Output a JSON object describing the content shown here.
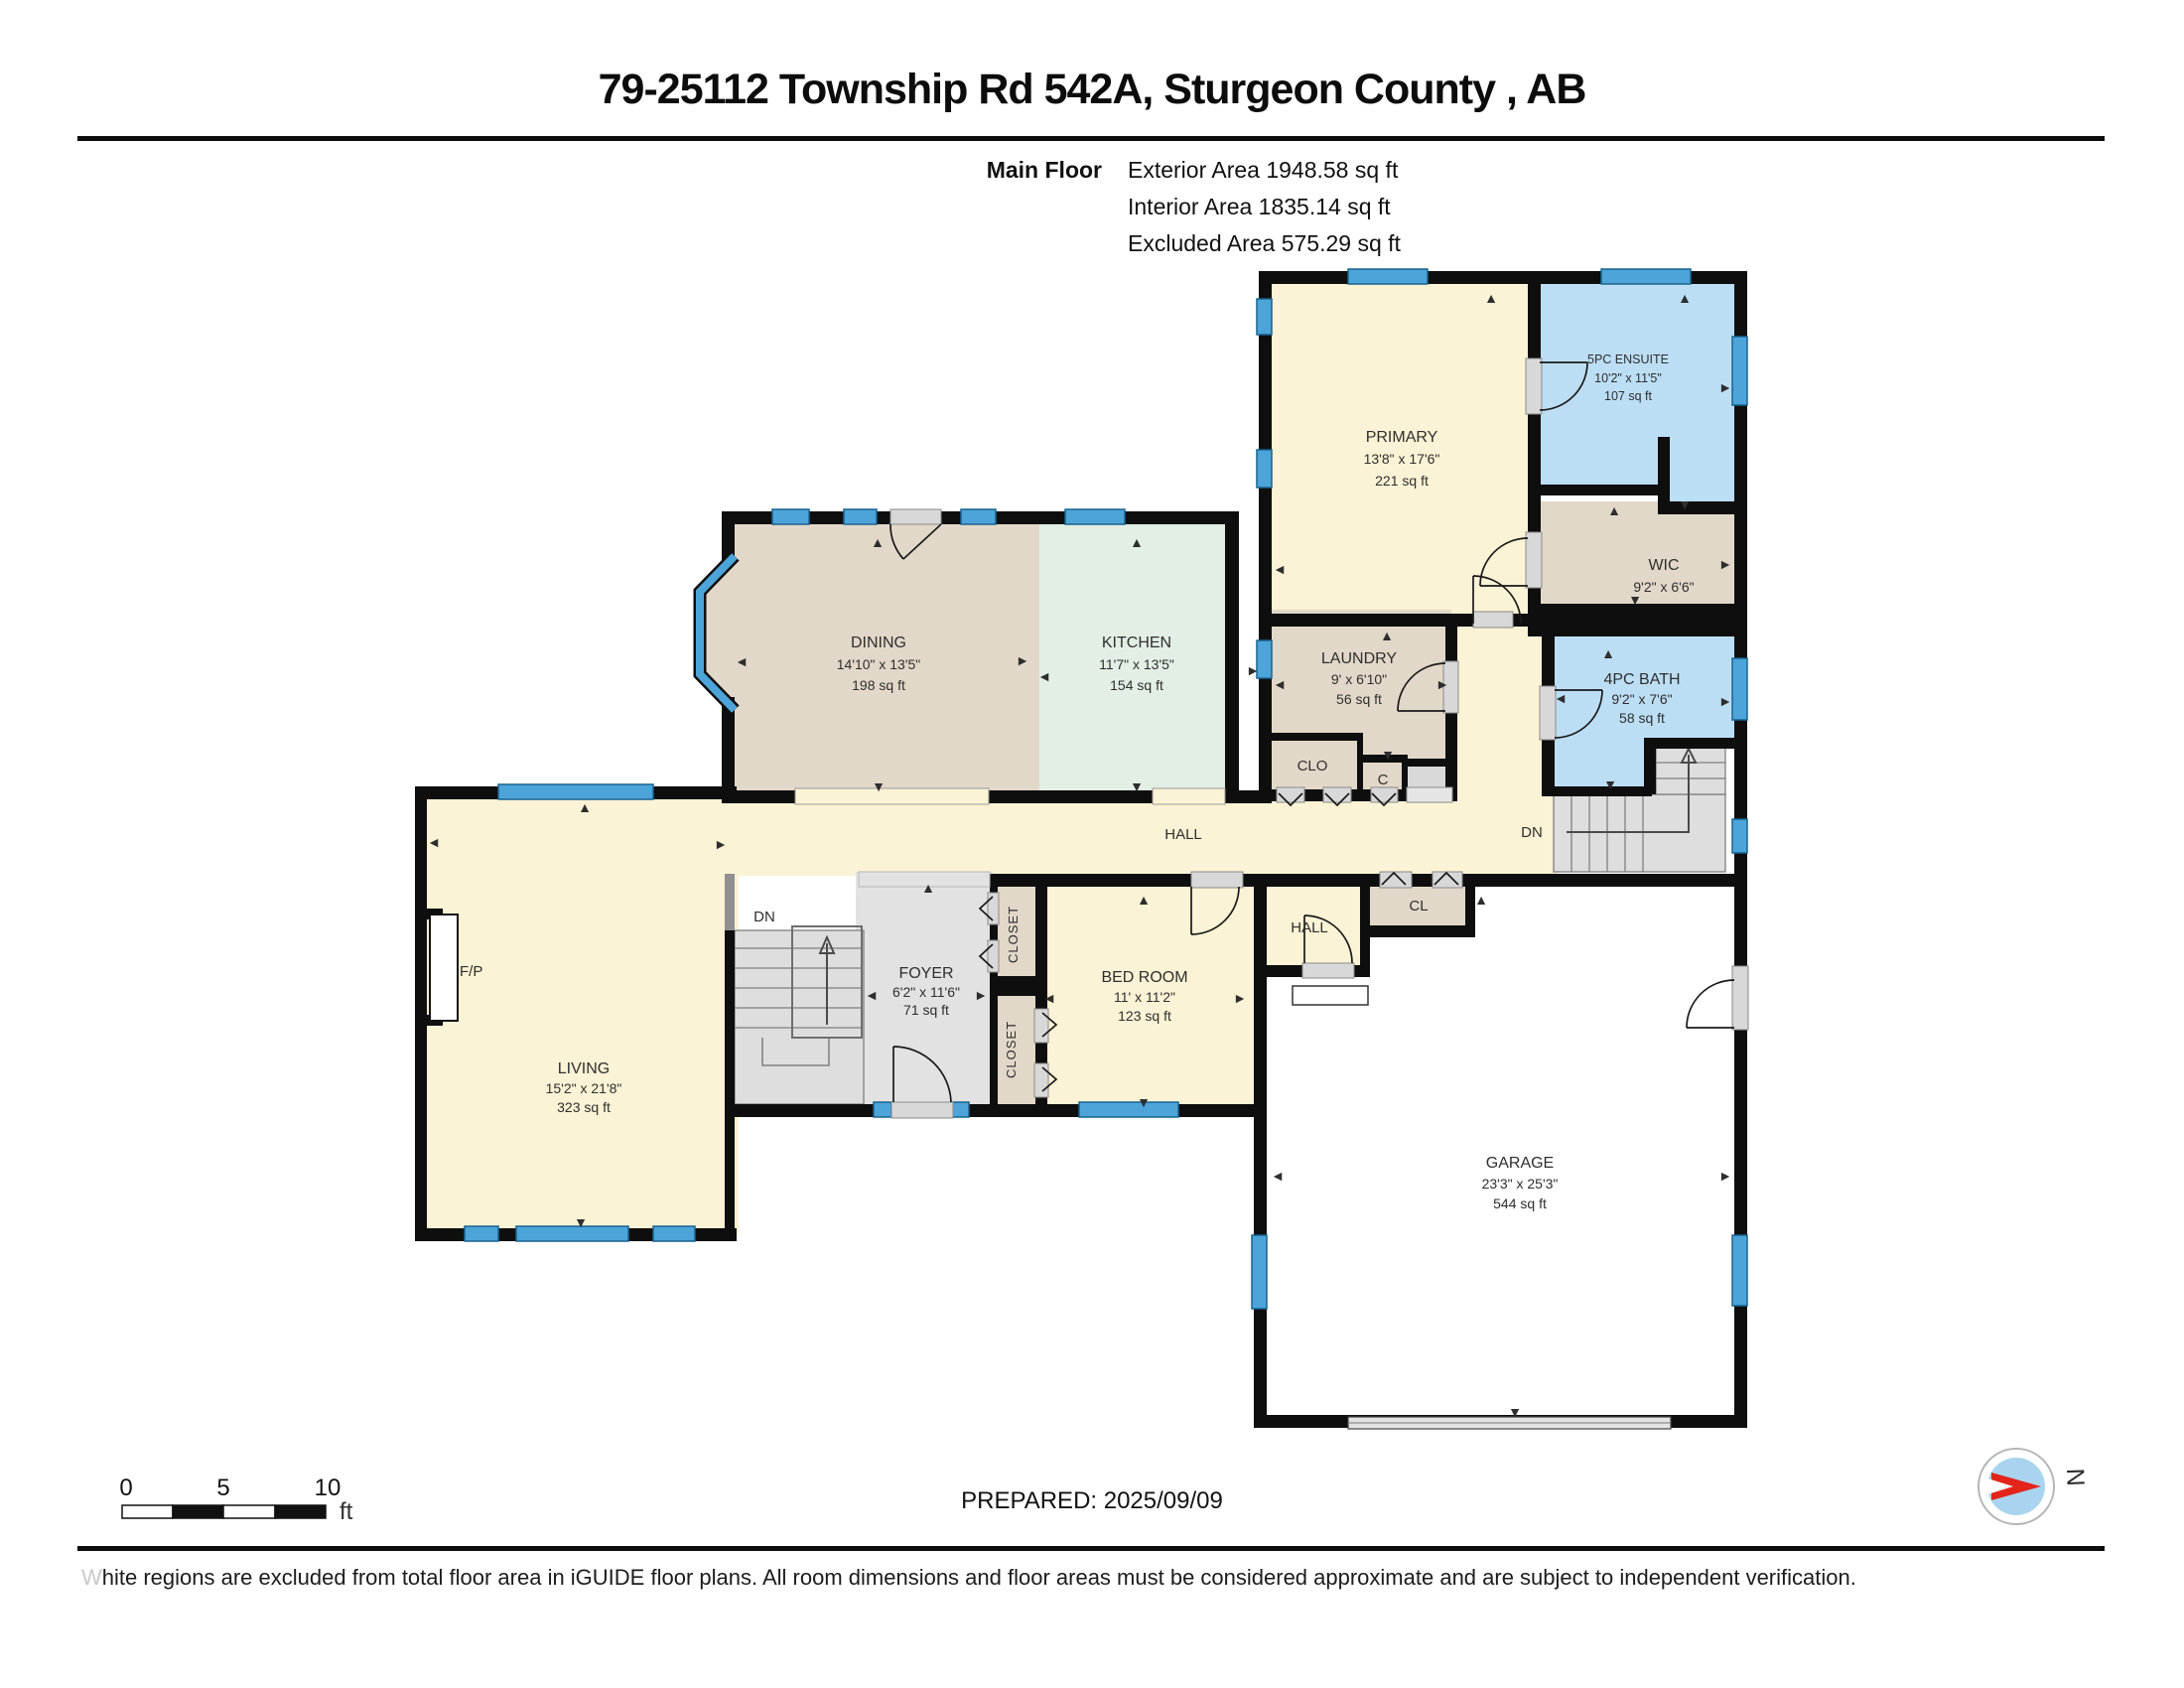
{
  "page": {
    "title": "79-25112 Township Rd 542A, Sturgeon County , AB"
  },
  "summary": {
    "floor_label": "Main Floor",
    "lines": [
      "Exterior Area 1948.58 sq ft",
      "Interior Area 1835.14 sq ft",
      "Excluded Area 575.29 sq ft"
    ]
  },
  "rooms": {
    "primary": {
      "name": "PRIMARY",
      "dims": "13'8\" x 17'6\"",
      "area": "221 sq ft"
    },
    "ensuite": {
      "name": "5PC ENSUITE",
      "dims": "10'2\" x 11'5\"",
      "area": "107 sq ft"
    },
    "wic": {
      "name": "WIC",
      "dims": "9'2\" x 6'6\""
    },
    "dining": {
      "name": "DINING",
      "dims": "14'10\" x 13'5\"",
      "area": "198 sq ft"
    },
    "kitchen": {
      "name": "KITCHEN",
      "dims": "11'7\" x 13'5\"",
      "area": "154 sq ft"
    },
    "laundry": {
      "name": "LAUNDRY",
      "dims": "9' x 6'10\"",
      "area": "56 sq ft"
    },
    "bath": {
      "name": "4PC BATH",
      "dims": "9'2\" x 7'6\"",
      "area": "58 sq ft"
    },
    "living": {
      "name": "LIVING",
      "dims": "15'2\" x 21'8\"",
      "area": "323 sq ft"
    },
    "foyer": {
      "name": "FOYER",
      "dims": "6'2\" x 11'6\"",
      "area": "71 sq ft"
    },
    "bedroom": {
      "name": "BED ROOM",
      "dims": "11' x 11'2\"",
      "area": "123 sq ft"
    },
    "garage": {
      "name": "GARAGE",
      "dims": "23'3\" x 25'3\"",
      "area": "544 sq ft"
    }
  },
  "labels": {
    "hall_main": "HALL",
    "hall_small": "HALL",
    "cl": "CL",
    "clo": "CLO",
    "c": "C",
    "dn_stairs": "DN",
    "dn_basement": "DN",
    "fireplace": "F/P",
    "closet_top": "CLOSET",
    "closet_bottom": "CLOSET"
  },
  "scale_bar": {
    "tick_0": "0",
    "tick_5": "5",
    "tick_10": "10",
    "unit": "ft"
  },
  "footer": {
    "prepared": "PREPARED: 2025/09/09",
    "disclaimer": "White regions are excluded from total floor area in iGUIDE floor plans. All room dimensions and floor areas must be considered approximate and are subject to independent verification.",
    "compass_north": "N"
  },
  "colors": {
    "wall": "#0e0e0e",
    "window_blue": "#4da4d9",
    "room_cream": "#fbf3d5",
    "room_tan": "#e2d8c9",
    "room_mint": "#e3efe5",
    "room_blue": "#bcdef5",
    "stairs_gray": "#dedede",
    "compass_red": "#e3241b",
    "compass_blue": "#a9d4ef"
  }
}
